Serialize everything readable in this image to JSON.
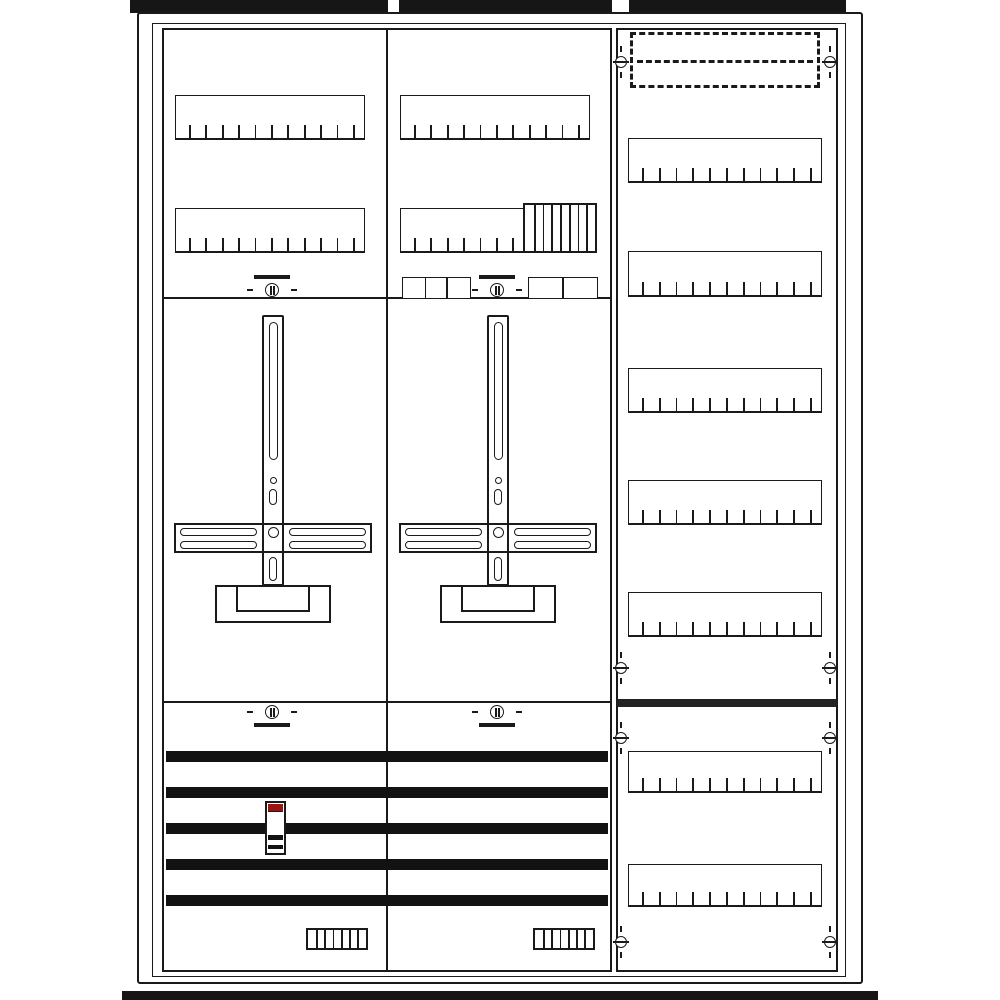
{
  "colors": {
    "line": "#1a1a1a",
    "background": "#ffffff",
    "dark_fill": "#161616",
    "red_accent": "#9e1212"
  },
  "cabinet": {
    "top_mounting_tabs": [
      [
        130,
        0,
        258,
        13
      ],
      [
        399,
        0,
        213,
        13
      ],
      [
        629,
        0,
        217,
        13
      ]
    ],
    "bottom_rail_bar": [
      122,
      991,
      756,
      9
    ],
    "outer_frame": [
      137,
      12,
      726,
      972
    ],
    "inner_frame": [
      152,
      23,
      694,
      954
    ],
    "left_middle_panel": [
      162,
      28,
      450,
      944
    ],
    "right_panel": [
      616,
      28,
      222,
      944
    ],
    "column_divider": [
      386,
      28,
      2,
      944
    ],
    "section_dividers": [
      [
        162,
        297,
        450,
        2
      ],
      [
        162,
        701,
        450,
        2
      ]
    ],
    "right_divider_bar": [
      617,
      699,
      220,
      8
    ],
    "knockout_cover": {
      "rect": [
        630,
        32,
        190,
        56
      ]
    },
    "din_rails": [
      {
        "section": "left-top",
        "rect": [
          175,
          95,
          190,
          45
        ],
        "ticks": 11
      },
      {
        "section": "left-top",
        "rect": [
          175,
          208,
          190,
          45
        ],
        "ticks": 11
      },
      {
        "section": "middle-top",
        "rect": [
          400,
          95,
          190,
          45
        ],
        "ticks": 11
      },
      {
        "section": "middle-top",
        "rect": [
          400,
          208,
          190,
          45
        ],
        "ticks": 11
      },
      {
        "section": "right",
        "rect": [
          628,
          138,
          194,
          45
        ],
        "ticks": 11
      },
      {
        "section": "right",
        "rect": [
          628,
          251,
          194,
          46
        ],
        "ticks": 11
      },
      {
        "section": "right",
        "rect": [
          628,
          368,
          194,
          45
        ],
        "ticks": 11
      },
      {
        "section": "right",
        "rect": [
          628,
          480,
          194,
          45
        ],
        "ticks": 11
      },
      {
        "section": "right",
        "rect": [
          628,
          592,
          194,
          45
        ],
        "ticks": 11
      },
      {
        "section": "right-bottom",
        "rect": [
          628,
          751,
          194,
          42
        ],
        "ticks": 11
      },
      {
        "section": "right-bottom",
        "rect": [
          628,
          864,
          194,
          43
        ],
        "ticks": 11
      }
    ],
    "module_block": {
      "rect": [
        523,
        203,
        74,
        50
      ],
      "stripes": 7
    },
    "small_box_groups": [
      {
        "rect": [
          402,
          277,
          69,
          21
        ],
        "cells": 3
      },
      {
        "rect": [
          528,
          277,
          70,
          21
        ],
        "cells": 2
      }
    ],
    "seal_screws": [
      {
        "cx": 272,
        "cy": 290,
        "bar": "above"
      },
      {
        "cx": 497,
        "cy": 290,
        "bar": "above"
      },
      {
        "cx": 272,
        "cy": 712,
        "bar": "below"
      },
      {
        "cx": 497,
        "cy": 712,
        "bar": "below"
      }
    ],
    "edge_screws": [
      {
        "cx": 621,
        "cy": 62
      },
      {
        "cx": 830,
        "cy": 62
      },
      {
        "cx": 621,
        "cy": 668
      },
      {
        "cx": 830,
        "cy": 668
      },
      {
        "cx": 621,
        "cy": 738
      },
      {
        "cx": 830,
        "cy": 738
      },
      {
        "cx": 621,
        "cy": 942
      },
      {
        "cx": 830,
        "cy": 942
      }
    ],
    "meter_mounts": [
      {
        "cx": 273
      },
      {
        "cx": 498
      }
    ],
    "busbars": {
      "x": 166,
      "w": 442,
      "h": 11,
      "ys": [
        751,
        787,
        823,
        859,
        895
      ]
    },
    "busbar_switch": {
      "rect": [
        265,
        801,
        21,
        54
      ]
    },
    "terminal_blocks": [
      {
        "rect": [
          306,
          928,
          62,
          22
        ],
        "cells": 7
      },
      {
        "rect": [
          533,
          928,
          62,
          22
        ],
        "cells": 7
      }
    ]
  }
}
